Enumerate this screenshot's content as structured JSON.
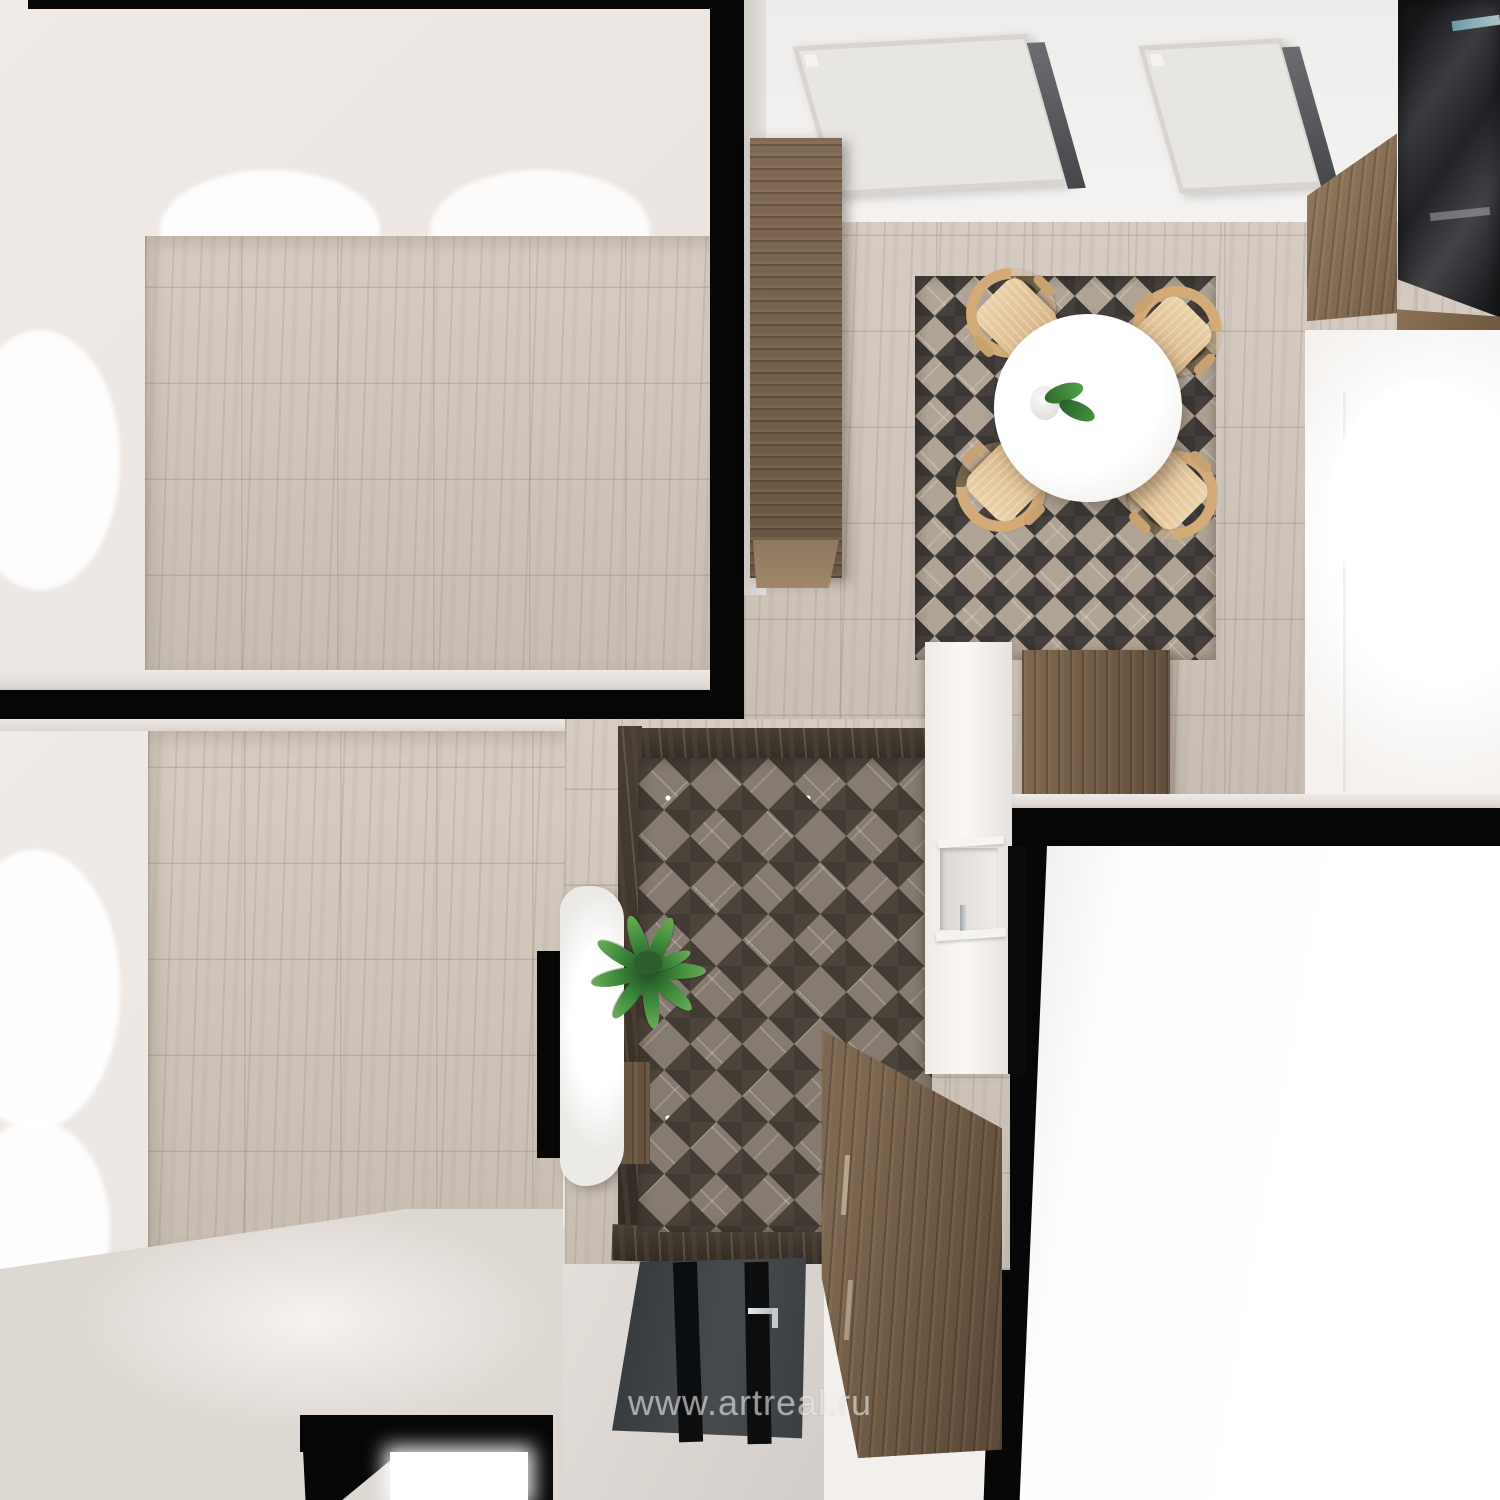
{
  "watermark": {
    "text": "www.artreal.ru"
  },
  "scene": {
    "description": "3D rendered top-down view of an apartment interior",
    "rooms": {
      "living_room": "beige marble tile room, top left",
      "bedroom": "beige marble tile room, bottom left",
      "kitchen_dining": "kitchen with skylights, round table, four wooden chairs, top right",
      "hallway": "hallway with 3D diamond mosaic floor, console with plant, dresser, entrance door",
      "bright_room": "overexposed white room, bottom right"
    },
    "objects": [
      "skylight-double-window",
      "skylight-single-window",
      "tall-wood-cabinet",
      "dining-rug",
      "round-dining-table",
      "table-plant",
      "dining-chair x4",
      "upper-wood-cabinets",
      "dark-glass-cabinets",
      "white-counter",
      "kitchen-base-cabinet",
      "wall-niche",
      "console-cabinet",
      "potted-palm-plant",
      "wood-dresser",
      "entrance-door",
      "door-handle"
    ],
    "palette": {
      "tile_beige": "#cdc3b9",
      "wall_white": "#f1ebe7",
      "wall_black": "#060606",
      "diamond_dark": "#423b33",
      "diamond_light": "#867b70",
      "wood_brown": "#76604d",
      "chair_wood": "#d5b083",
      "door_gray": "#3f4245",
      "leaf_green": "#3f8b3c",
      "glass_teal": "#bfe2ec"
    }
  }
}
